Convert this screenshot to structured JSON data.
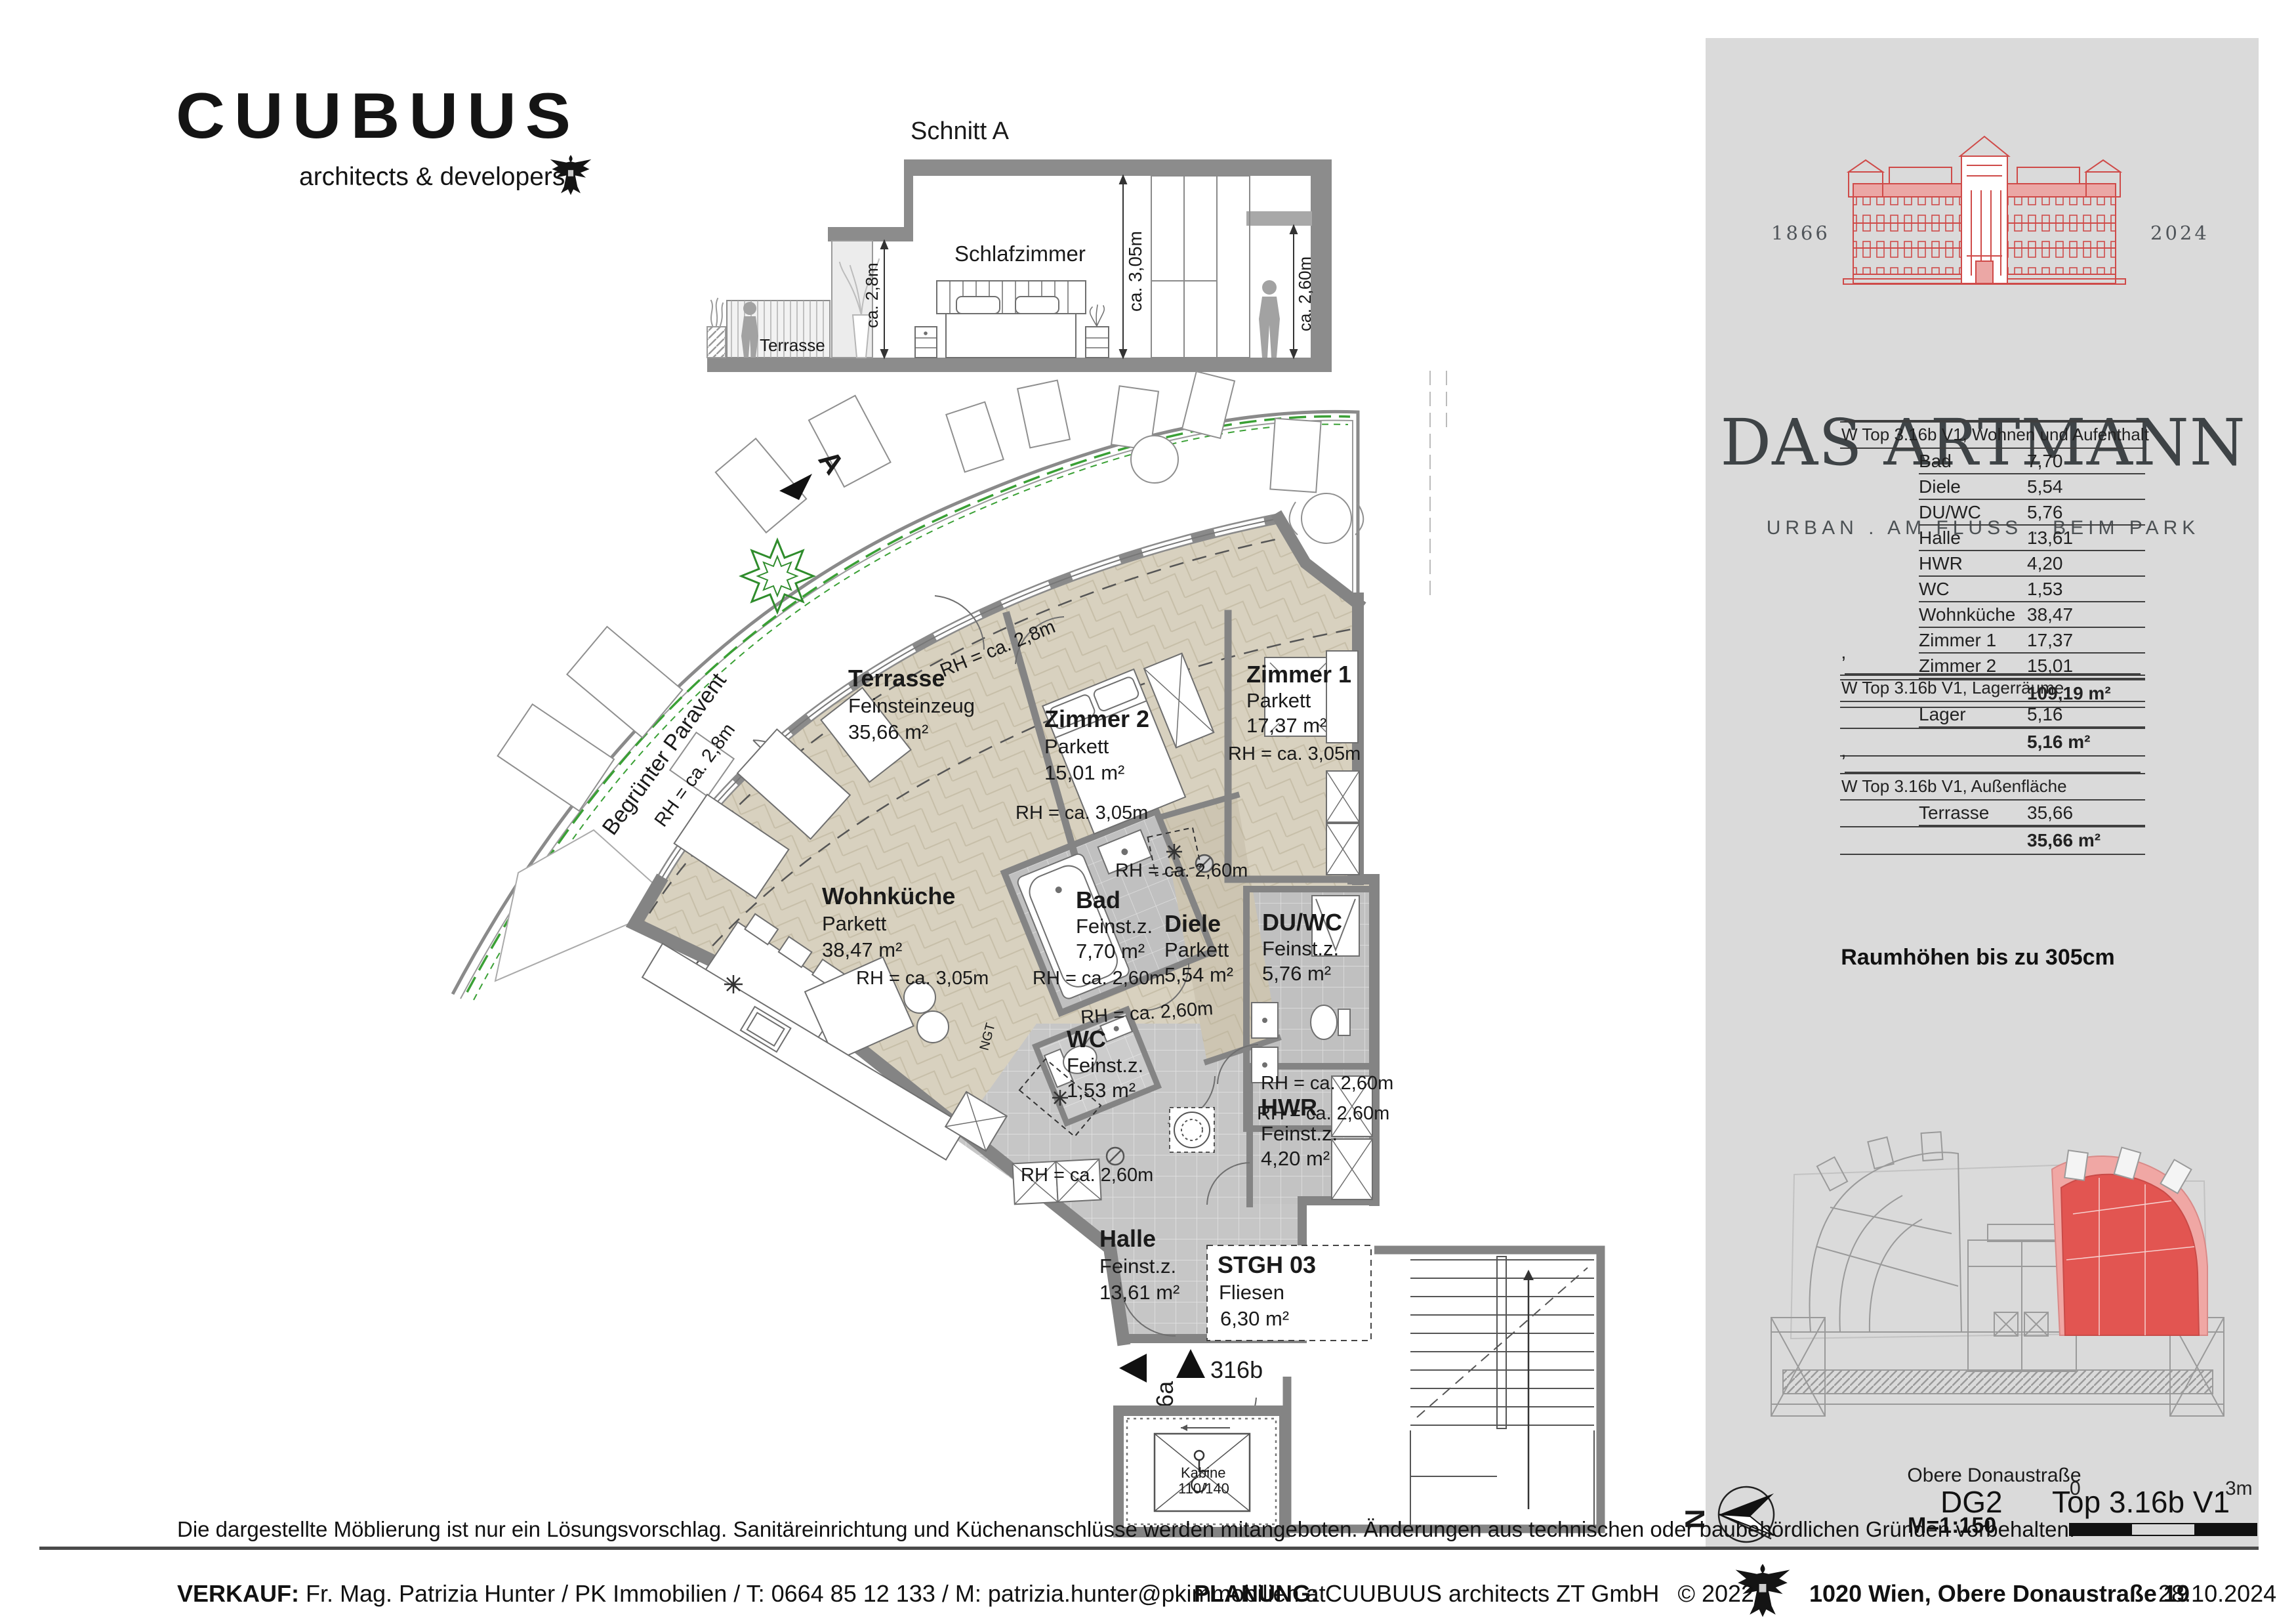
{
  "colors": {
    "accent_red": "#e25551",
    "accent_red_light": "#f0a7a4",
    "panel_bg": "#dadada",
    "beige": "#d8d1bf",
    "green": "#3aa035"
  },
  "logo": {
    "name": "CUUBUUS",
    "tagline": "architects & developers",
    "eagle_icon": "austrian-eagle"
  },
  "section": {
    "title": "Schnitt A",
    "room": "Schlafzimmer",
    "terrace": "Terrasse",
    "dim_28": "ca. 2,8m",
    "dim_305": "ca. 3,05m",
    "dim_260": "ca. 2,60m"
  },
  "panel": {
    "year_left": "1866",
    "year_right": "2024",
    "title": "DAS ARTMANN",
    "subtitle": "URBAN . AM FLUSS . BEIM PARK",
    "tick": "’",
    "tables": [
      {
        "header": "W Top 3.16b V1, Wohnen und Aufenthalt",
        "rows": [
          [
            "Bad",
            "7,70"
          ],
          [
            "Diele",
            "5,54"
          ],
          [
            "DU/WC",
            "5,76"
          ],
          [
            "Halle",
            "13,61"
          ],
          [
            "HWR",
            "4,20"
          ],
          [
            "WC",
            "1,53"
          ],
          [
            "Wohnküche",
            "38,47"
          ],
          [
            "Zimmer 1",
            "17,37"
          ],
          [
            "Zimmer 2",
            "15,01"
          ]
        ],
        "total": "109,19 m²"
      },
      {
        "header": "W Top 3.16b V1, Lagerräume",
        "rows": [
          [
            "Lager",
            "5,16"
          ]
        ],
        "total": "5,16 m²"
      },
      {
        "header": "W Top 3.16b V1, Außenfläche",
        "rows": [
          [
            "Terrasse",
            "35,66"
          ]
        ],
        "total": "35,66 m²"
      }
    ],
    "room_height_note": "Raumhöhen bis zu 305cm",
    "street": "Obere Donaustraße",
    "level": "DG2",
    "unit": "Top 3.16b V1",
    "north": "N",
    "scale": "M=1:150",
    "scale_zero": "0",
    "scale_three": "3m"
  },
  "plan": {
    "paravent": "Begrünter Paravent",
    "section_marker": "A",
    "ngt": "NGT",
    "rooms": [
      {
        "name": "Terrasse",
        "floor": "Feinsteinzeug",
        "area": "35,66 m²"
      },
      {
        "name": "Wohnküche",
        "floor": "Parkett",
        "area": "38,47 m²"
      },
      {
        "name": "Zimmer 2",
        "floor": "Parkett",
        "area": "15,01 m²"
      },
      {
        "name": "Zimmer 1",
        "floor": "Parkett",
        "area": "17,37 m²"
      },
      {
        "name": "Bad",
        "floor": "Feinst.z.",
        "area": "7,70 m²"
      },
      {
        "name": "Diele",
        "floor": "Parkett",
        "area": "5,54 m²"
      },
      {
        "name": "DU/WC",
        "floor": "Feinst.z.",
        "area": "5,76 m²"
      },
      {
        "name": "WC",
        "floor": "Feinst.z.",
        "area": "1,53 m²"
      },
      {
        "name": "HWR",
        "floor": "Feinst.z.",
        "area": "4,20 m²"
      },
      {
        "name": "Halle",
        "floor": "Feinst.z.",
        "area": "13,61 m²"
      },
      {
        "name": "STGH 03",
        "floor": "Fliesen",
        "area": "6,30 m²"
      }
    ],
    "rh_28": "RH = ca. 2,8m",
    "rh_305": "RH = ca. 3,05m",
    "rh_260": "RH = ca. 2,60m",
    "door_a": "316a",
    "door_b": "316b",
    "elevator": "Kabine",
    "elevator_size": "110/140"
  },
  "disclaimer": "Die dargestellte Möblierung ist nur ein Lösungsvorschlag. Sanitäreinrichtung und Küchenanschlüsse werden mitangeboten. Änderungen aus technischen oder baubehördlichen Gründen vorbehalten.",
  "footer": {
    "sales_label": "VERKAUF:",
    "sales": "Fr. Mag. Patrizia Hunter / PK Immobilien / T: 0664 85 12 133 / M: patrizia.hunter@pkimmobilien.at",
    "planning_label": "PLANUNG:",
    "planning": "CUUBUUS architects ZT GmbH",
    "copyright": "©  2022",
    "address": "1020 Wien, Obere Donaustraße 19",
    "date": "28.10.2024"
  }
}
